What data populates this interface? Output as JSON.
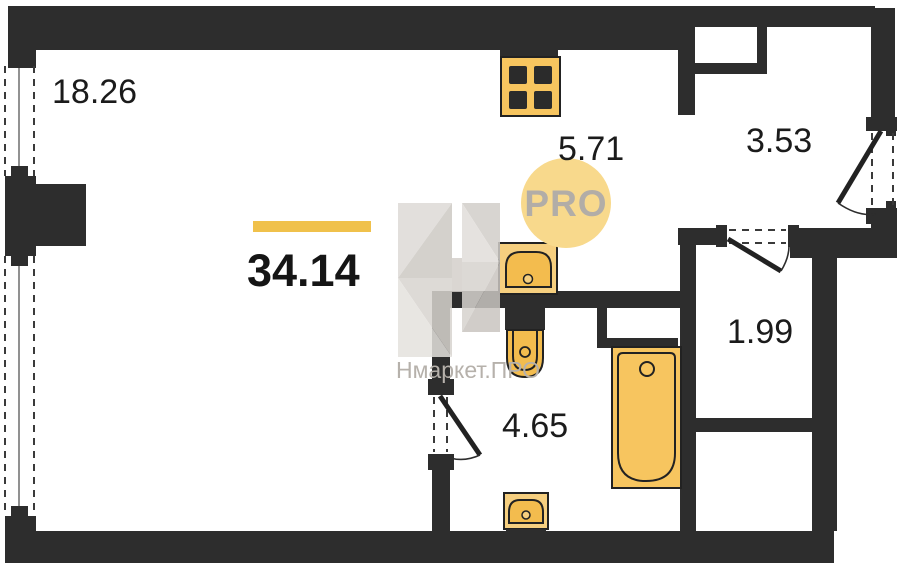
{
  "plan": {
    "total_area": "34.14",
    "rooms": [
      {
        "id": "living",
        "area": "18.26"
      },
      {
        "id": "kitchen",
        "area": "5.71"
      },
      {
        "id": "hallway",
        "area": "3.53"
      },
      {
        "id": "storage",
        "area": "1.99"
      },
      {
        "id": "bathroom",
        "area": "4.65"
      }
    ],
    "watermark": {
      "brand": "Нмаркет.ПРО",
      "badge": "PRO"
    },
    "colors": {
      "wall": "#2d2d2d",
      "fixture": "#f7c55f",
      "fixture_light": "#f6cf7f",
      "fixture_deep": "#f3bc4e",
      "accent": "#f0c14b",
      "badge_bg": "#f8d98c",
      "badge_text": "#b2ada7",
      "watermark_text": "#b6b1ab"
    }
  }
}
